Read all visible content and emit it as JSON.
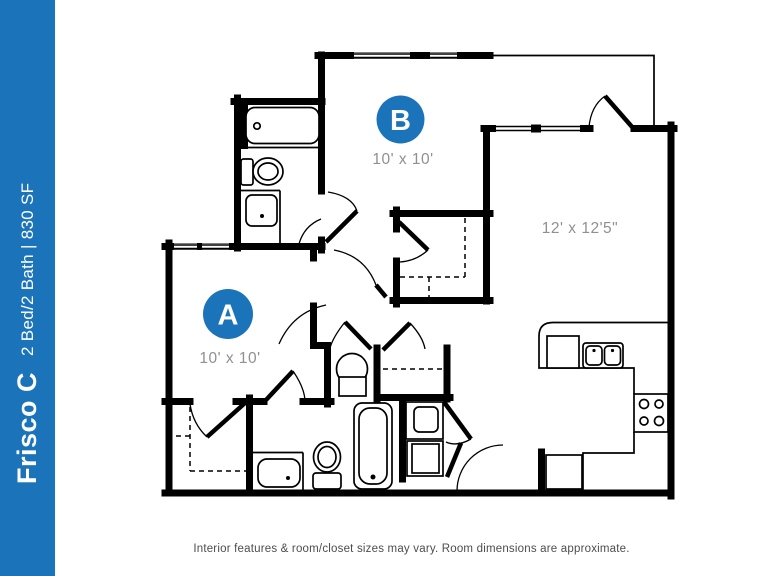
{
  "sidebar": {
    "title": "Frisco C",
    "subtitle": "2 Bed/2 Bath | 830 SF"
  },
  "colors": {
    "accent": "#1b74ba",
    "dim_text": "#909090",
    "walls": "#000000"
  },
  "rooms": {
    "bedroom_a": {
      "marker": "A",
      "dimensions": "10' x 10'"
    },
    "bedroom_b": {
      "marker": "B",
      "dimensions": "10' x 10'"
    },
    "living": {
      "dimensions": "12' x 12'5\""
    }
  },
  "footer": {
    "disclaimer": "Interior features & room/closet sizes may vary. Room dimensions are approximate."
  }
}
